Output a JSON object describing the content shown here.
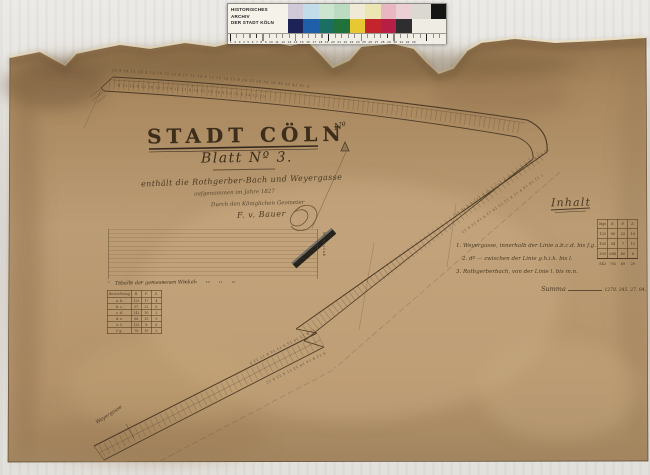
{
  "palette": {
    "paper_base": "#b4946a",
    "paper_dark": "#8a6a46",
    "ink": "#3c2e1b",
    "scan_background": "#e6e4e0",
    "calibration_black": "#141414"
  },
  "archive_bar": {
    "label_line1": "HISTORISCHES ARCHIV",
    "label_line2": "DER STADT KÖLN",
    "patches_top": [
      "#cfc9d8",
      "#c2dcea",
      "#cde4cf",
      "#bcdcc2",
      "#efe9d6",
      "#ece6b2",
      "#e9b7c1",
      "#eccfd4"
    ],
    "patches_bottom": [
      "#1d2257",
      "#1f5ea8",
      "#1a6e62",
      "#20713a",
      "#e8c832",
      "#c4252c",
      "#b61e45",
      "#2e2e30"
    ],
    "patch_wide_light": "#dbd8d1",
    "patch_wide_black": "#141414",
    "ruler_numbers": "1 2 3 4 5 6 7 8 9 10 11 12 13 14 15 16 17 18 19 20 21 22 23 24 25 26 27 28 29 30 31 32 33"
  },
  "title_block": {
    "main": "STADT CÖLN",
    "sheet": "Blatt Nº 3.",
    "subtitle": "enthält die Rothgerber-Bach und Weyergasse",
    "surveyed": "aufgenommen im Jahre 1827",
    "surveyor_line": "Durch den Königlichen Geometer",
    "signature": "F. v. Bauer"
  },
  "compass": {
    "north_label": "Nº"
  },
  "inhalt": {
    "heading": "Inhalt",
    "items": [
      "1. Weyergasse, innerhalb der Linie a.b.c.d. bis f.g.",
      "2. dº  —  zwischen der Linie g.h.i.k. bis l.",
      "3. Rothgerberbach, von der Linie l. bis m.n."
    ],
    "table": {
      "headers": [
        "Mgn",
        "R.",
        "F.",
        "Z."
      ],
      "rows": [
        [
          "132",
          "90",
          "22",
          "10"
        ],
        [
          "105",
          "54",
          "7",
          "11"
        ],
        [
          "305",
          "648",
          "40",
          "8"
        ]
      ],
      "sum_row": [
        "542",
        "792",
        "69",
        "29"
      ]
    },
    "summa_label": "Summa",
    "summa_values": "1278. 345. 27. 04."
  },
  "left_table": {
    "caption": "Tabelle der gemessenen Winkel",
    "headers": [
      "Bezeichnung",
      "R.",
      "F.",
      "Z."
    ],
    "rows": [
      [
        "a. b.",
        "125",
        "17",
        "4"
      ],
      [
        "b. c.",
        "97",
        "22",
        "8"
      ],
      [
        "c. d.",
        "143",
        "10",
        "2"
      ],
      [
        "d. e.",
        "88",
        "15",
        "9"
      ],
      [
        "e. f.",
        "132",
        "8",
        "6"
      ],
      [
        "f. g.",
        "76",
        "19",
        "3"
      ]
    ]
  },
  "grid_scale": {
    "numbers": "1 2 3 4 5 6 7 8 9 10 11 12",
    "label": "Maasstab"
  },
  "map": {
    "street_label": "Weyergasse",
    "measurements": {
      "a_top": "12 9 14 11 16 8 13 10 15 12 9 17 11 14 8 12 15 10 13 9 16 12 20 30 50 40 45 41 42 d.",
      "a_bottom": "8 11 14 9 12 16 10 13 8 15 11 9 14 12 10 16 9 13 11 8 14 12 15",
      "b_left": "13 9 11 15 8 12 14 10 9 16 11 13 8 12 15 9 10 14",
      "b_right": "7 12 10 14 9 11 8 13 15 10 12 9 14 11 8 13",
      "c_left": "11 8 13 10 15 9 12 14 8 11 13 9",
      "c_right": "9 12 8 14 10 13 11 9 15 8 12"
    }
  }
}
